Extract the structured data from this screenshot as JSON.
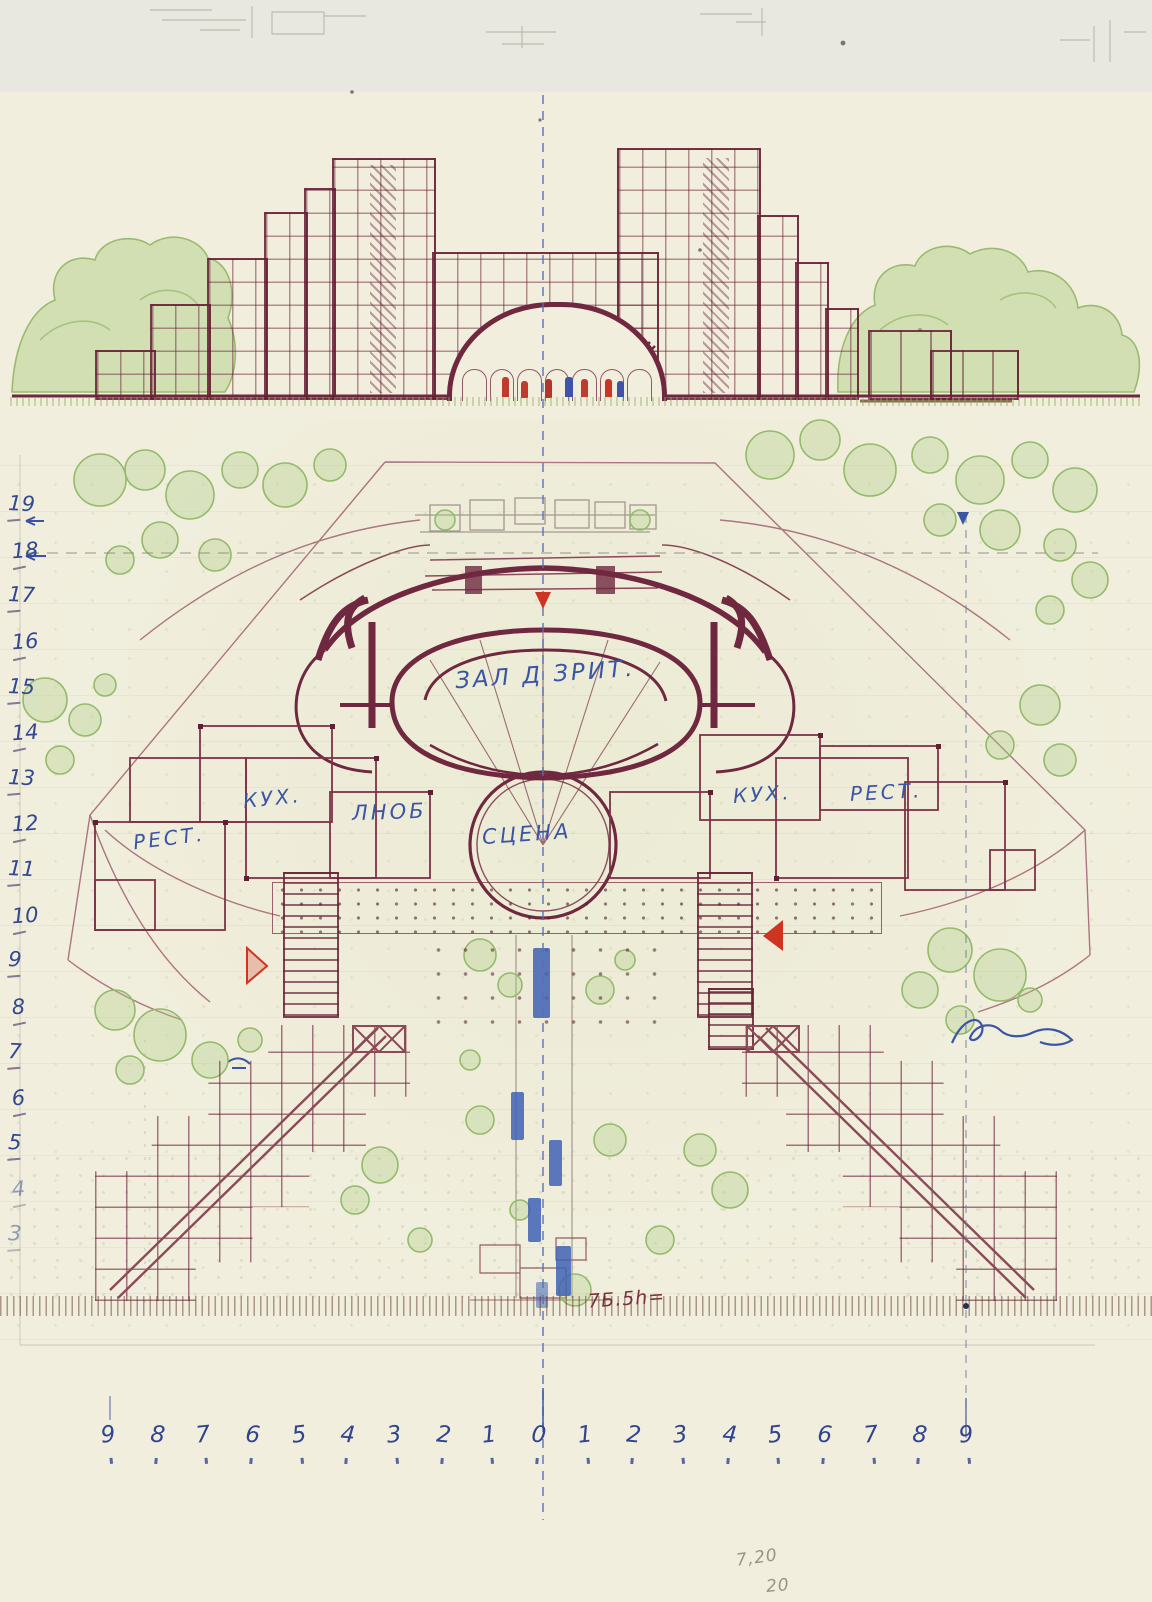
{
  "labels": {
    "hall": "ЗАЛ Д ЗРИТ.",
    "stage": "СЦЕНА",
    "kitchen_left": "КУХ.",
    "restaurant_left": "РЕСТ.",
    "service": "ЛНОБ",
    "kitchen_right": "КУХ.",
    "restaurant_right": "РЕСТ.",
    "level_note": "7Б.5h="
  },
  "axes": {
    "left_numbers": [
      "19",
      "18",
      "17",
      "16",
      "15",
      "14",
      "13",
      "12",
      "11",
      "10",
      "9",
      "8",
      "7",
      "6",
      "5",
      "4",
      "3"
    ],
    "bottom_numbers": [
      "9",
      "8",
      "7",
      "6",
      "5",
      "4",
      "3",
      "2",
      "1",
      "0",
      "1",
      "2",
      "3",
      "4",
      "5",
      "6",
      "7",
      "8",
      "9"
    ]
  },
  "corner_notes": {
    "dimension": "7,20",
    "sheet_number": "20"
  },
  "markers": {
    "center": "red-triangle-down",
    "left": "red-triangle-right",
    "right": "red-triangle-left",
    "axis_top_right": "blue-arrow-down"
  },
  "colors": {
    "paper": "#f1eedd",
    "ink_maroon": "#6f2840",
    "tree_green": "#9abb6f",
    "annotation_blue": "#3b55a5",
    "marker_red": "#cf3322",
    "pencil": "#9b9486"
  }
}
